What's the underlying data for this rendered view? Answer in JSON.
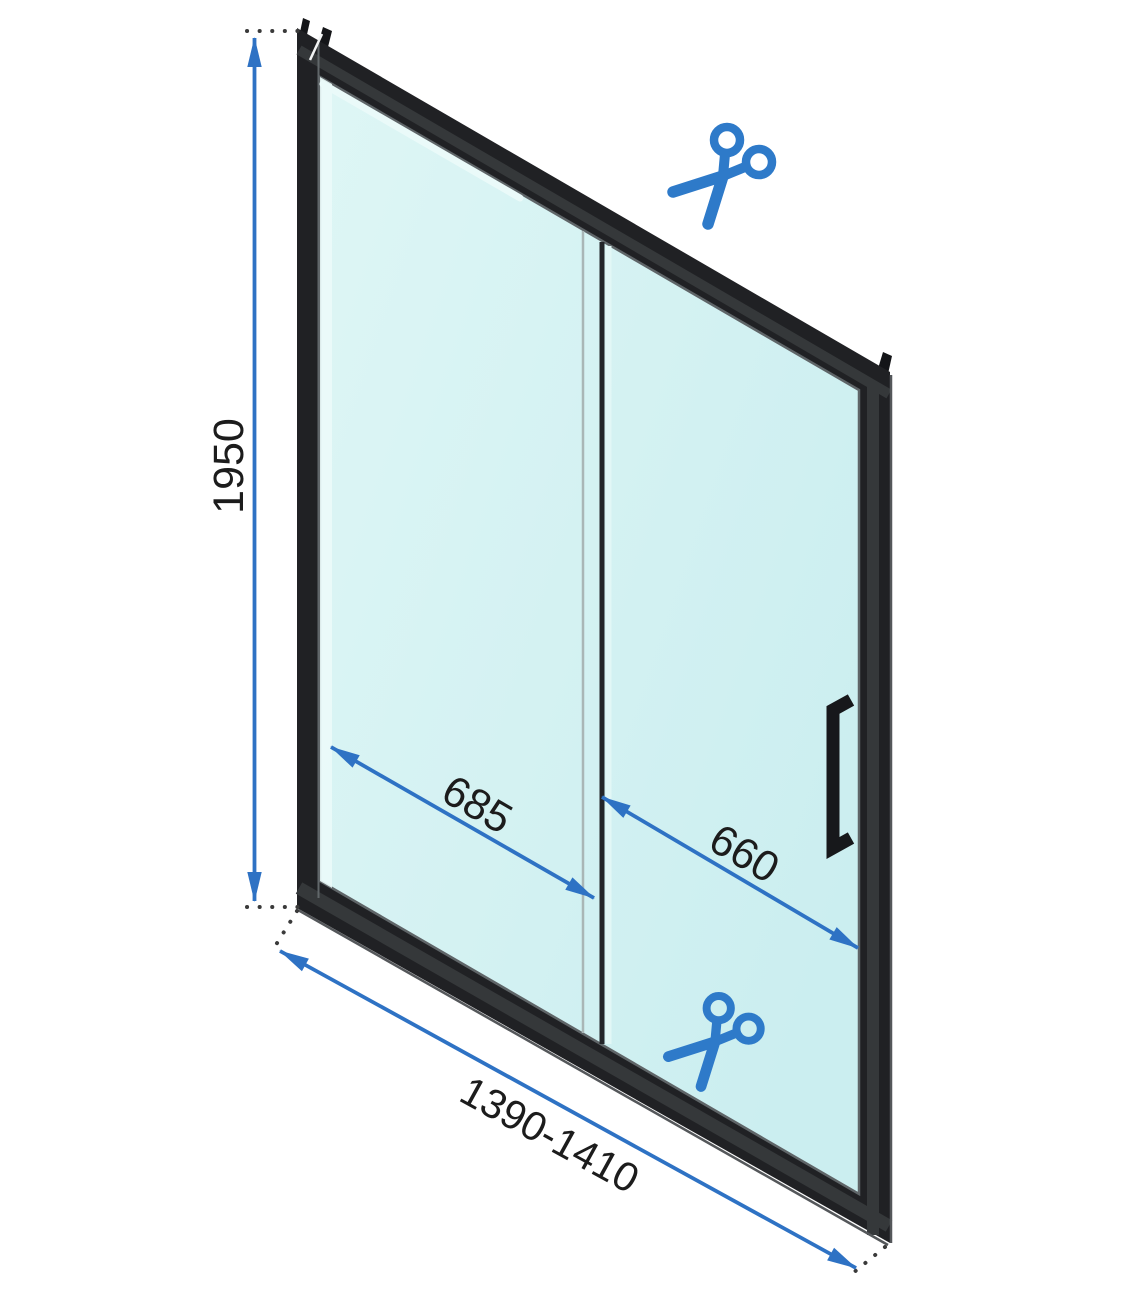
{
  "figure": {
    "labels": {
      "height": "1950",
      "left_panel": "685",
      "right_panel": "660",
      "width_range": "1390-1410"
    },
    "icons": [
      {
        "name": "scissors-icon-top"
      },
      {
        "name": "scissors-icon-bottom"
      },
      {
        "name": "door-handle"
      }
    ],
    "colors": {
      "background": "#ffffff",
      "frame_black": "#202124",
      "glass_cyan": "#d9f4f3",
      "dimension_blue": "#2e72c4",
      "scissors_blue": "#2e7ac9",
      "label_text": "#1c1c1c"
    }
  }
}
